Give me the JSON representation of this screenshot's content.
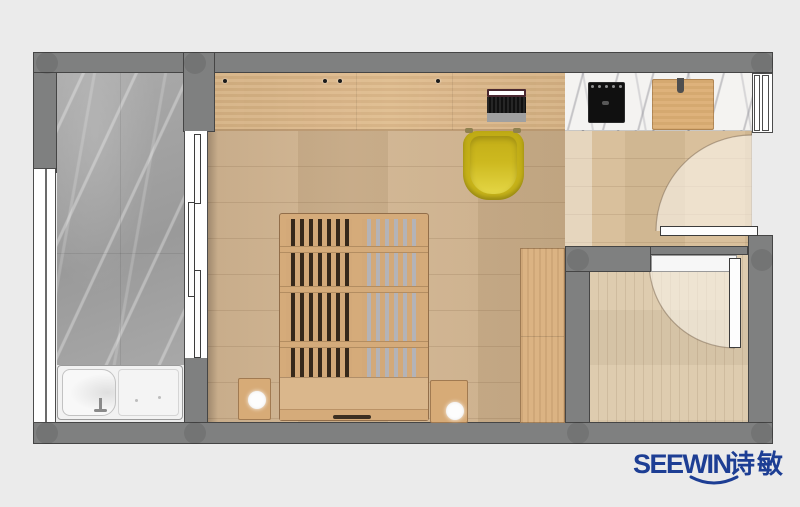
{
  "brand": {
    "name": "SEEWIN",
    "name_cn": "诗敏",
    "color": "#1d3e94"
  },
  "palette": {
    "background": "#ebebeb",
    "wall": "#7f8080",
    "wall_outline": "#454545",
    "column_shadow": "rgba(40,40,40,0.13)",
    "bathroom_marble": "#a5a5a5",
    "counter_marble": "#f4f3f1",
    "desk_wood": "#ddb786",
    "bedroom_floor": "#cfb18b",
    "corridor_floor": "#d7bd97",
    "room_floor": "#dcc9ab",
    "furniture_wood": "#d5ab7a",
    "bed_slat_gap_dark": "#37291b",
    "bed_slat_gap_light": "#b4b3b7",
    "chair_yellow": "#c9b51a",
    "cooktop_black": "#101010",
    "fixture_white": "#f7f7f7"
  },
  "elements": {
    "rooms": [
      "bathroom",
      "bedroom",
      "kitchen-corridor",
      "side-room"
    ],
    "furniture": [
      "bathtub",
      "shower-sliding-door",
      "platform-bed",
      "nightstand-left",
      "nightstand-right",
      "bed-lamp-left",
      "bed-lamp-right",
      "wardrobe",
      "desk",
      "laptop",
      "desk-chair",
      "induction-cooktop",
      "cutting-board"
    ],
    "openings": [
      "left-window",
      "right-window",
      "entry-door",
      "side-room-door"
    ],
    "structure": [
      "outer-walls",
      "structural-columns"
    ]
  }
}
